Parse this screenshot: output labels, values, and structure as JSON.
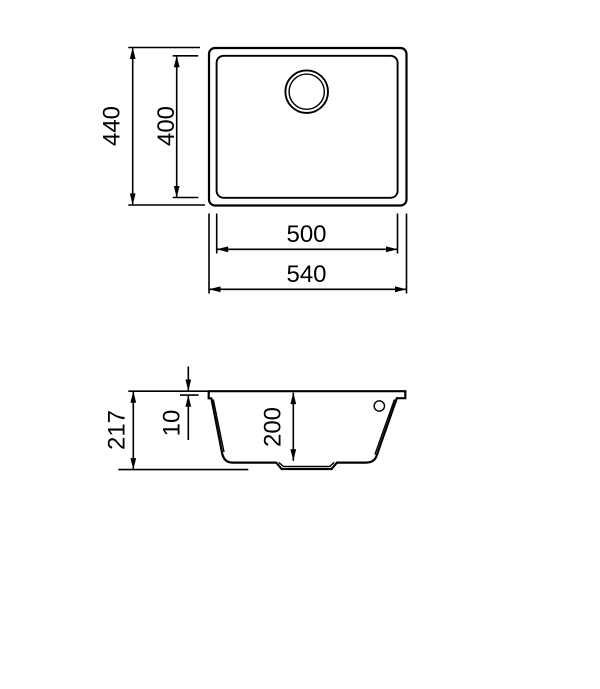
{
  "colors": {
    "background": "#ffffff",
    "line": "#000000",
    "text": "#000000"
  },
  "top_view": {
    "labels": {
      "overall_height": "440",
      "bowl_height": "400",
      "bowl_width": "500",
      "overall_width": "540"
    }
  },
  "side_view": {
    "labels": {
      "overall_depth": "217",
      "rim_height": "10",
      "bowl_depth": "200"
    }
  }
}
